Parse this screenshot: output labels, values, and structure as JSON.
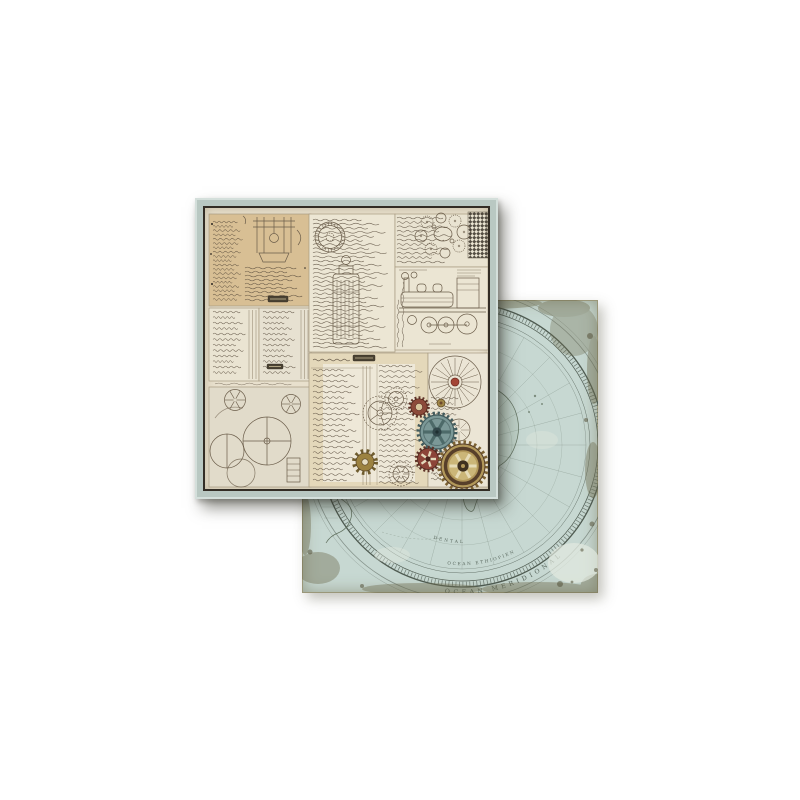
{
  "scene": {
    "type": "product-photo",
    "background_color": "#ffffff",
    "subject": "Double-sided vintage scrapbook paper: steampunk collage front sheet overlapping antique world-map back sheet"
  },
  "front_sheet": {
    "name": "steampunk-collage-side",
    "mat_color": "#b9c8c2",
    "frame_color": "#332d25",
    "paper_color": "#e8e0cd",
    "ink_color": "#56493a",
    "panels": [
      {
        "id": "panel-manuscript-tan",
        "desc": "tan handwritten manuscript with press sketch and caption plate"
      },
      {
        "id": "panel-ledger-pages",
        "desc": "two ruled ledger pages of script"
      },
      {
        "id": "panel-mechanism-drawings",
        "desc": "flywheel and pulley sketches with ladder"
      },
      {
        "id": "panel-script-column",
        "desc": "dense script column with round stamp and column diagram"
      },
      {
        "id": "panel-gear-train",
        "desc": "gear train sketch with dark lattice corner"
      },
      {
        "id": "panel-locomotive",
        "desc": "steam locomotive technical drawing"
      },
      {
        "id": "panel-ledger-gears",
        "desc": "ledger rows with pocket-watch gear sketches"
      },
      {
        "id": "panel-fan-wheel",
        "desc": "spoked fan wheel sketch with colored gears cluster"
      }
    ],
    "gears": {
      "slate": {
        "body": "#7b9897",
        "rim": "#415a5c",
        "spokes": "#4d6a69",
        "hub": "#32474a"
      },
      "brass_large": {
        "body": "#b2985a",
        "ring": "#573f2a",
        "spokes": "#e6dcb8",
        "hub": "#3f3120",
        "teeth": "#7c6233"
      },
      "maroon_donut": {
        "body": "#8c4a3a",
        "hole": "#d8c69d",
        "teeth": "#5f3328"
      },
      "maroon_spoke": {
        "body": "#8c4438",
        "spokes": "#e4dabc",
        "hub": "#4a251d",
        "teeth": "#5f3328"
      },
      "brass_sprocket": {
        "body": "#9c8240",
        "hole": "#e6ddc2",
        "teeth": "#6f5c2e"
      },
      "brass_knob": {
        "body": "#a08748",
        "hub": "#6e4a2e"
      }
    }
  },
  "back_sheet": {
    "name": "antique-map-side",
    "base_color": "#c7d8d2",
    "line_color": "#4e5a50",
    "land_tint": "#8ba08b",
    "distress_color": "#6d6a4c",
    "labels": {
      "outer_arc": "OCEAN MERIDIONAL",
      "middle_arc": "OCEAN ETHIOPIEN",
      "inner_arc": "DENTAL"
    }
  }
}
